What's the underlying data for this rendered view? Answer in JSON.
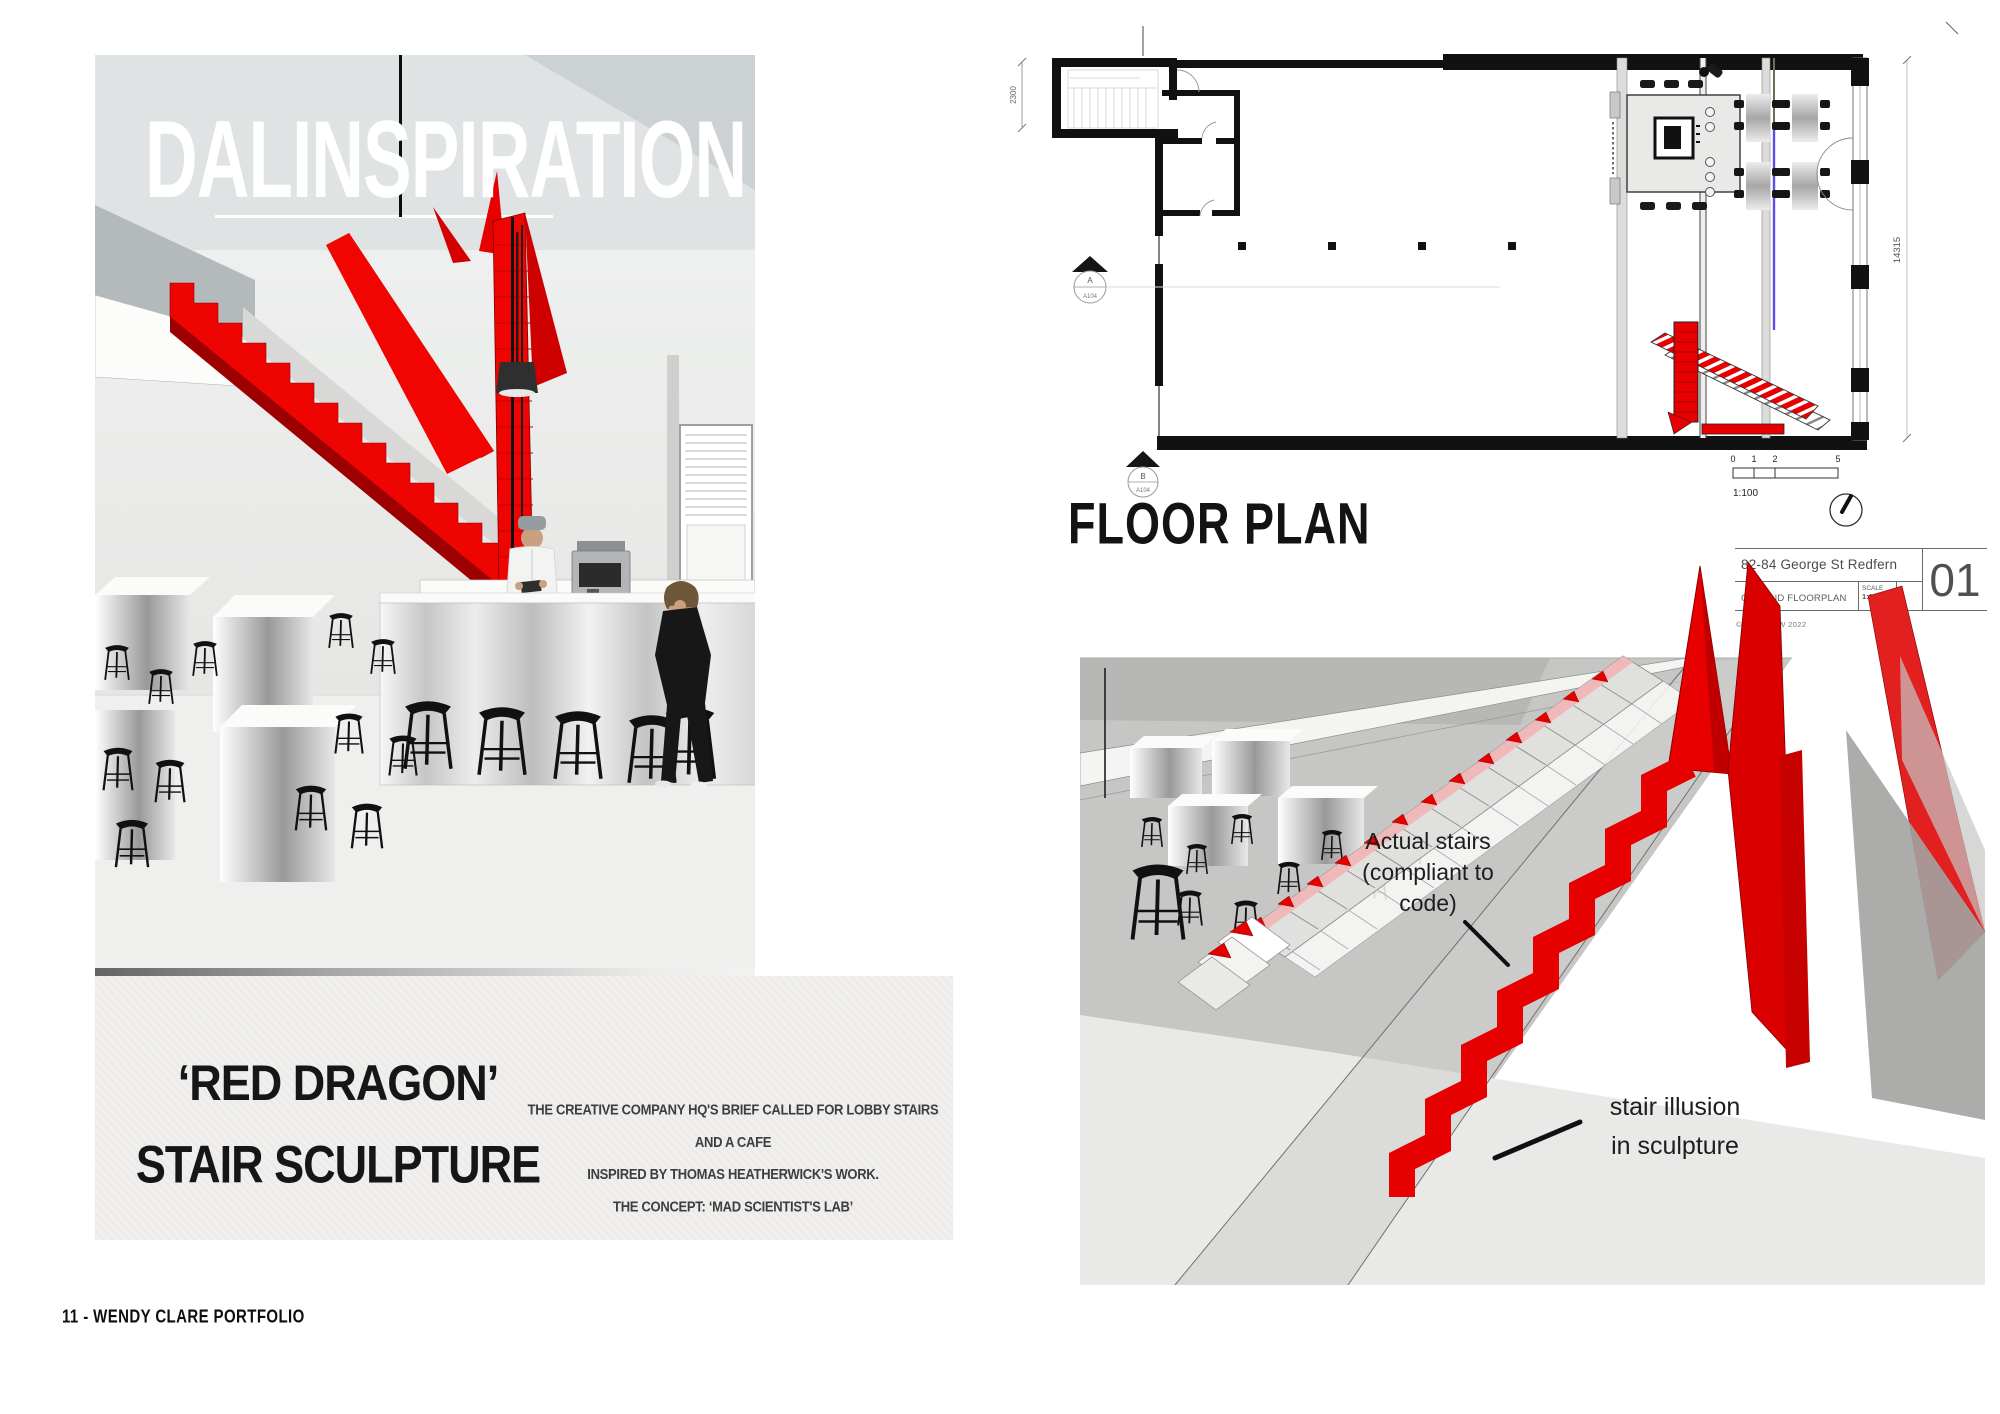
{
  "page": {
    "footer": "11 -  WENDY CLARE PORTFOLIO"
  },
  "left_panel": {
    "title": "DALINSPIRATION",
    "heading_line1": "‘RED DRAGON’",
    "heading_line2": "STAIR SCULPTURE",
    "description_line1": "THE  CREATIVE COMPANY HQ'S  BRIEF CALLED FOR LOBBY STAIRS AND A CAFE",
    "description_line2": "INSPIRED BY THOMAS HEATHERWICK'S WORK.",
    "description_line3": "THE CONCEPT: ‘MAD SCIENTIST'S LAB’"
  },
  "floor_plan": {
    "label": "FLOOR PLAN",
    "dimension_left": "2300",
    "dimension_right": "14315",
    "marker_a": {
      "letter": "A",
      "sheet": "A104"
    },
    "marker_b": {
      "letter": "B",
      "sheet": "A104"
    },
    "scale_bar": {
      "ticks": [
        "0",
        "1",
        "2",
        "5"
      ],
      "ratio": "1:100"
    },
    "title_block": {
      "address": "82-84 George St Redfern",
      "drawing_name": "GROUND FLOORPLAN",
      "scale_label": "SCALE",
      "scale_value": "1:100",
      "sheet_number": "01",
      "copyright": "© TAFE NSW 2022"
    }
  },
  "render_panel": {
    "annotation_actual_line1": "Actual stairs",
    "annotation_actual_line2": "(compliant to",
    "annotation_actual_line3": "code)",
    "annotation_illusion_line1": "stair illusion",
    "annotation_illusion_line2": "in sculpture"
  },
  "colors": {
    "sculpture_red": "#ee0400",
    "plan_red": "#e80000",
    "plan_blue": "#5b4fe8",
    "ink": "#111111"
  }
}
